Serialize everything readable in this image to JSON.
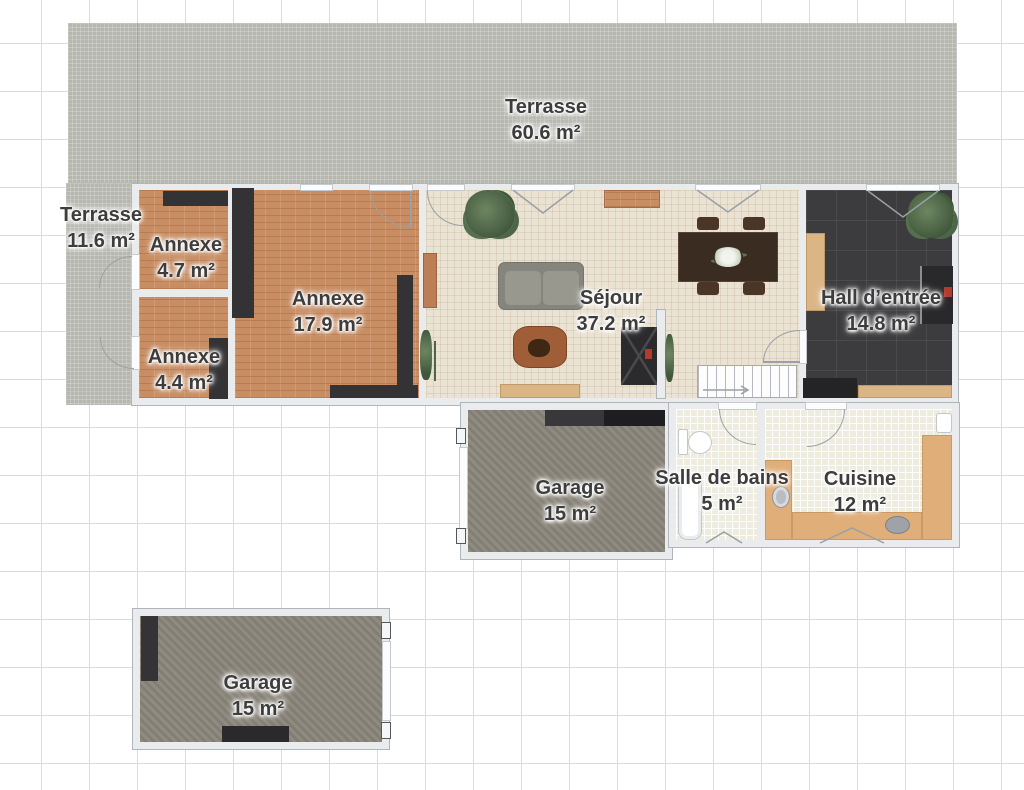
{
  "title": "Plan d'étage",
  "rooms": {
    "terrasse_top": {
      "name": "Terrasse",
      "area": "60.6 m²"
    },
    "terrasse_left": {
      "name": "Terrasse",
      "area": "11.6 m²"
    },
    "annexe_47": {
      "name": "Annexe",
      "area": "4.7 m²"
    },
    "annexe_44": {
      "name": "Annexe",
      "area": "4.4 m²"
    },
    "annexe_179": {
      "name": "Annexe",
      "area": "17.9 m²"
    },
    "sejour": {
      "name": "Séjour",
      "area": "37.2 m²"
    },
    "hall": {
      "name": "Hall d’entrée",
      "area": "14.8 m²"
    },
    "garage_attached": {
      "name": "Garage",
      "area": "15 m²"
    },
    "salle_de_bains": {
      "name": "Salle de bains",
      "area": "5 m²"
    },
    "cuisine": {
      "name": "Cuisine",
      "area": "12 m²"
    },
    "garage_detached": {
      "name": "Garage",
      "area": "15 m²"
    }
  },
  "colors": {
    "terrace": "#b6b8b0",
    "brick": "#c88d62",
    "living_floor": "#eae2d2",
    "hall_floor": "#3c3c3f",
    "garage_floor": "#8a857a",
    "tile_floor": "#edecdf",
    "counter_wood": "#e0ae79",
    "wall": "#e9ebed",
    "label_text": "#3d3d3d",
    "furniture_dark": "#333335",
    "accent_red": "#b43a2e",
    "grid_line": "#dcdcdc"
  }
}
